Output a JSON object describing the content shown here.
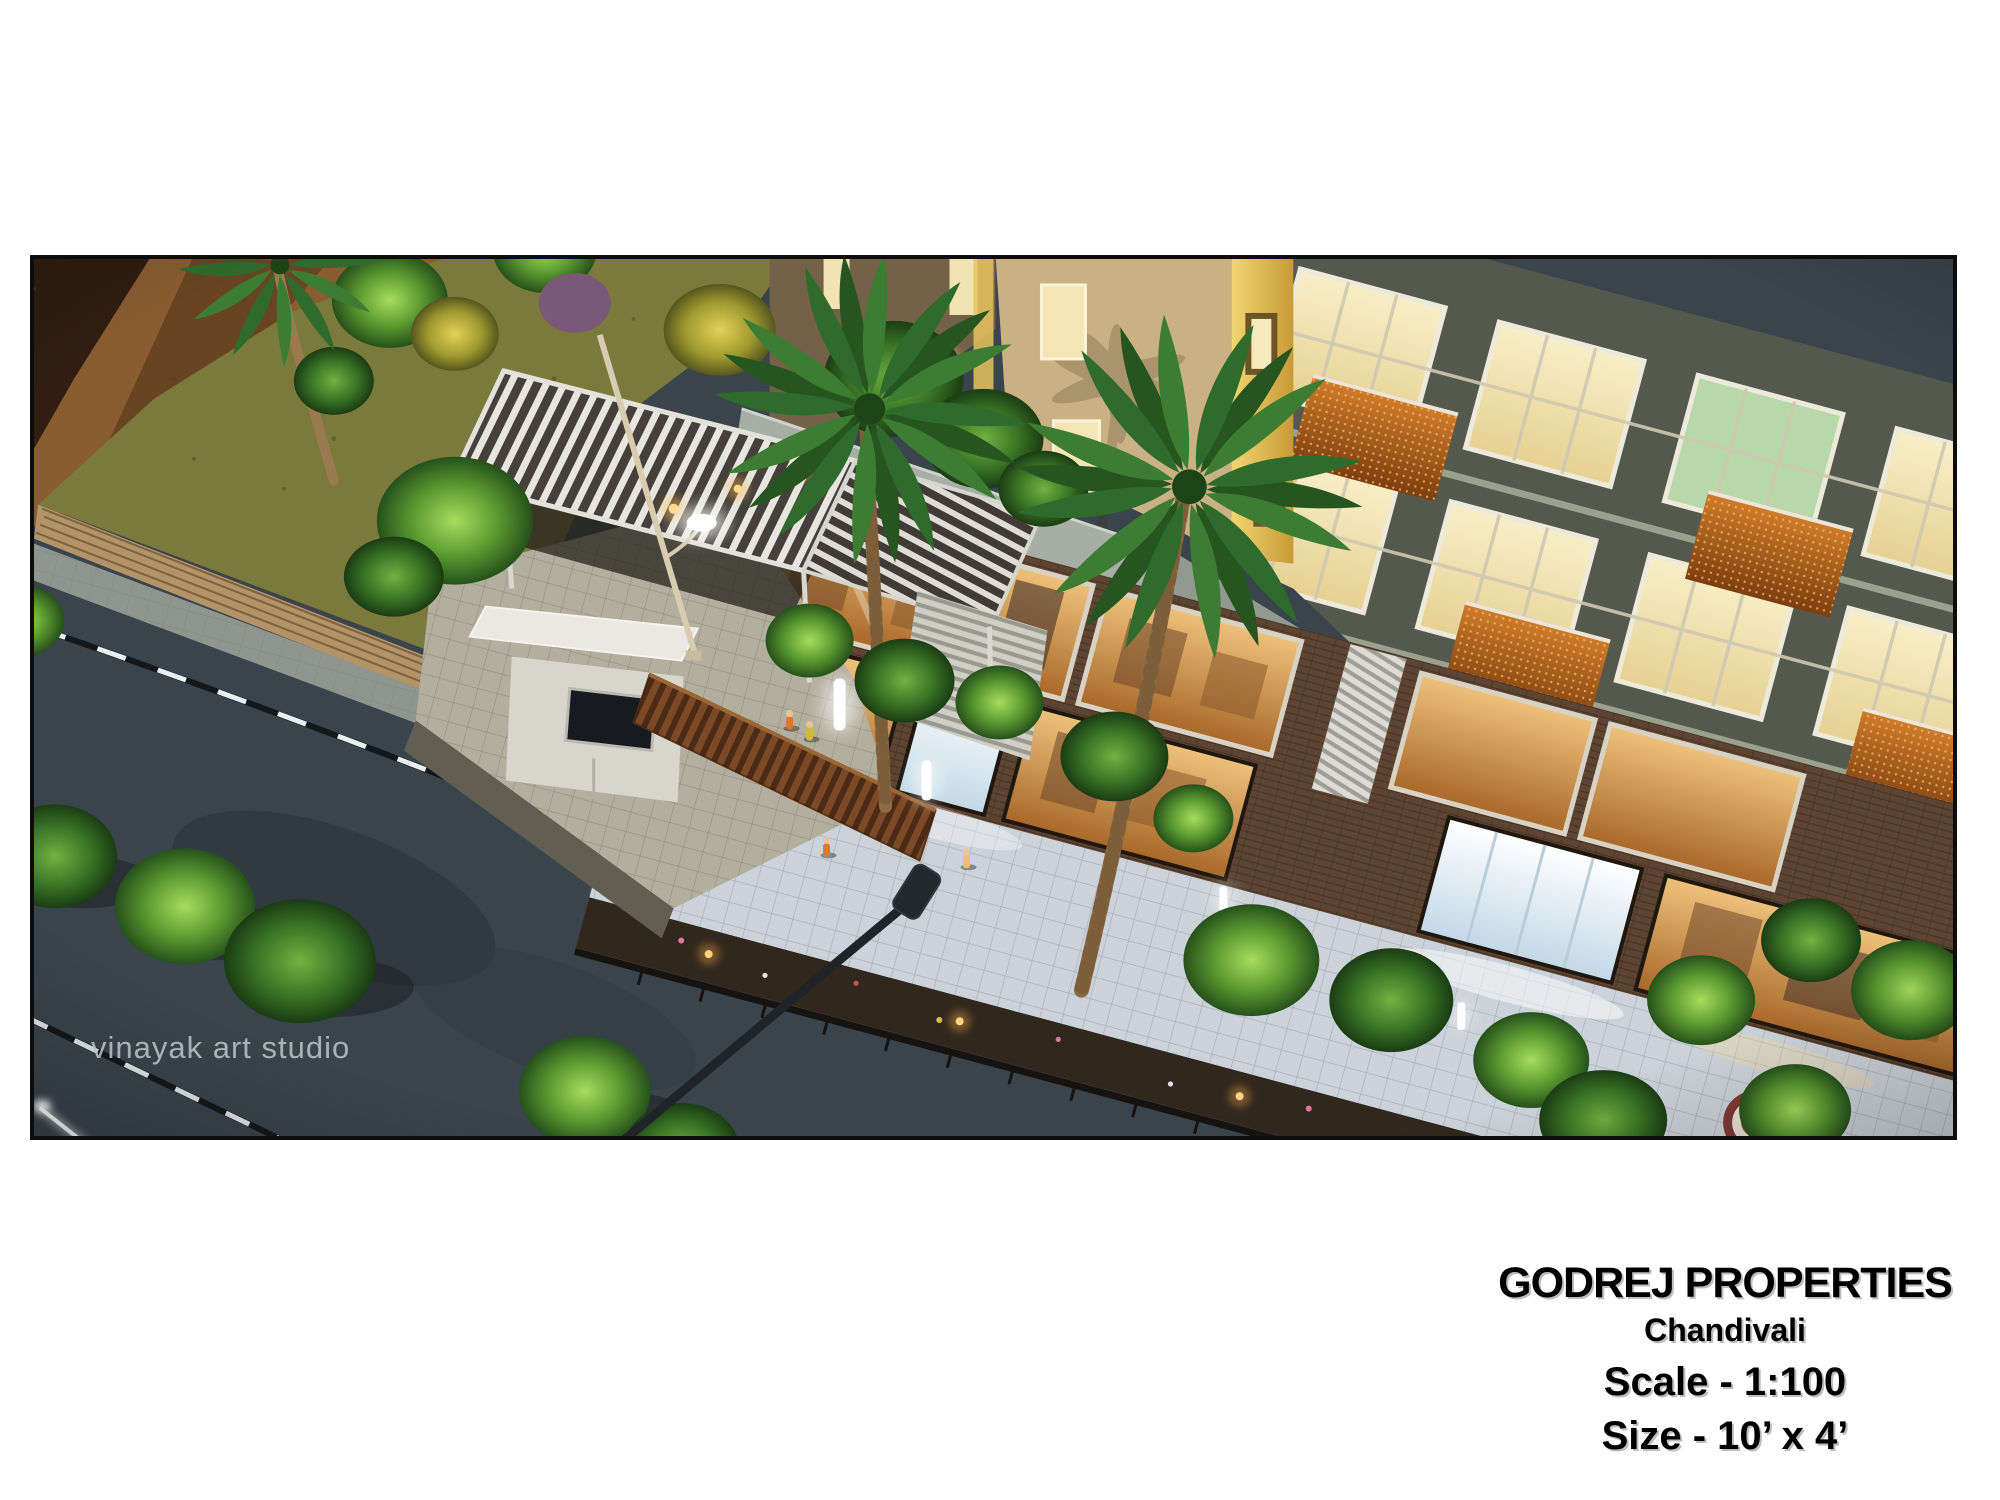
{
  "page": {
    "background": "#ffffff"
  },
  "photo": {
    "watermark": "vinayak art studio",
    "frame_color": "#0d0d0d",
    "palette": {
      "asphalt": "#3a444c",
      "lawn": "#7b7a3c",
      "brick_wall": "#8a5c31",
      "plank_walkway": "#b29468",
      "podium_deck": "#a7aea6",
      "side_wall": "#c9b183",
      "lit_edge": "#e8c35f",
      "facade": "#55584c",
      "window_glow": "#efe2b2",
      "window_green": "#b7d8a8",
      "balcony_copper": "#b35c1d",
      "storefront_amber": "#c98d4e",
      "storefront_cool": "#dfe8ee",
      "promenade_tiles": "#ccd2d9",
      "pergola": "#d8d8d0",
      "compound_tiles": "#b3af9f",
      "road_line": "#e9eef0",
      "foliage_bright": "#5b9a31",
      "foliage_dark": "#3c7827",
      "palm_green": "#2f6b2c"
    }
  },
  "caption": {
    "title": "GODREJ PROPERTIES",
    "subtitle": "Chandivali",
    "scale_label": "Scale - 1:100",
    "size_label": "Size - 10’ x 4’",
    "color": "#000000"
  }
}
